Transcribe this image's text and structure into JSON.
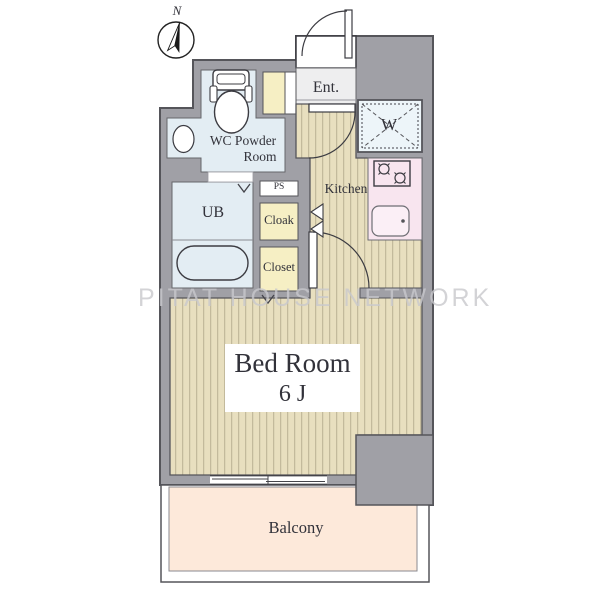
{
  "compass": {
    "north_label": "N"
  },
  "watermark": {
    "text": "PITAT HOUSE NETWORK"
  },
  "rooms": {
    "entrance": {
      "label": "Ent."
    },
    "washer": {
      "label": "W"
    },
    "wc_powder_room": {
      "line1": "WC Powder",
      "line2": "Room"
    },
    "unit_bath": {
      "label": "UB"
    },
    "pipe_space": {
      "label": "PS"
    },
    "cloak": {
      "label": "Cloak"
    },
    "closet": {
      "label": "Closet"
    },
    "kitchen": {
      "label": "Kitchen"
    },
    "bedroom": {
      "label": "Bed Room",
      "size": "6 J"
    },
    "balcony": {
      "label": "Balcony"
    }
  },
  "colors": {
    "wall": "#a0a0a6",
    "flooring": "#e8dfbf",
    "floor_stripe": "#c3ba9c",
    "wet_area": "#e3edf3",
    "storage": "#f6efc4",
    "kitchen_counter": "#f8e5ef",
    "balcony": "#fde9da",
    "watermark_gray": "#c9c9cd",
    "text": "#32323a"
  }
}
